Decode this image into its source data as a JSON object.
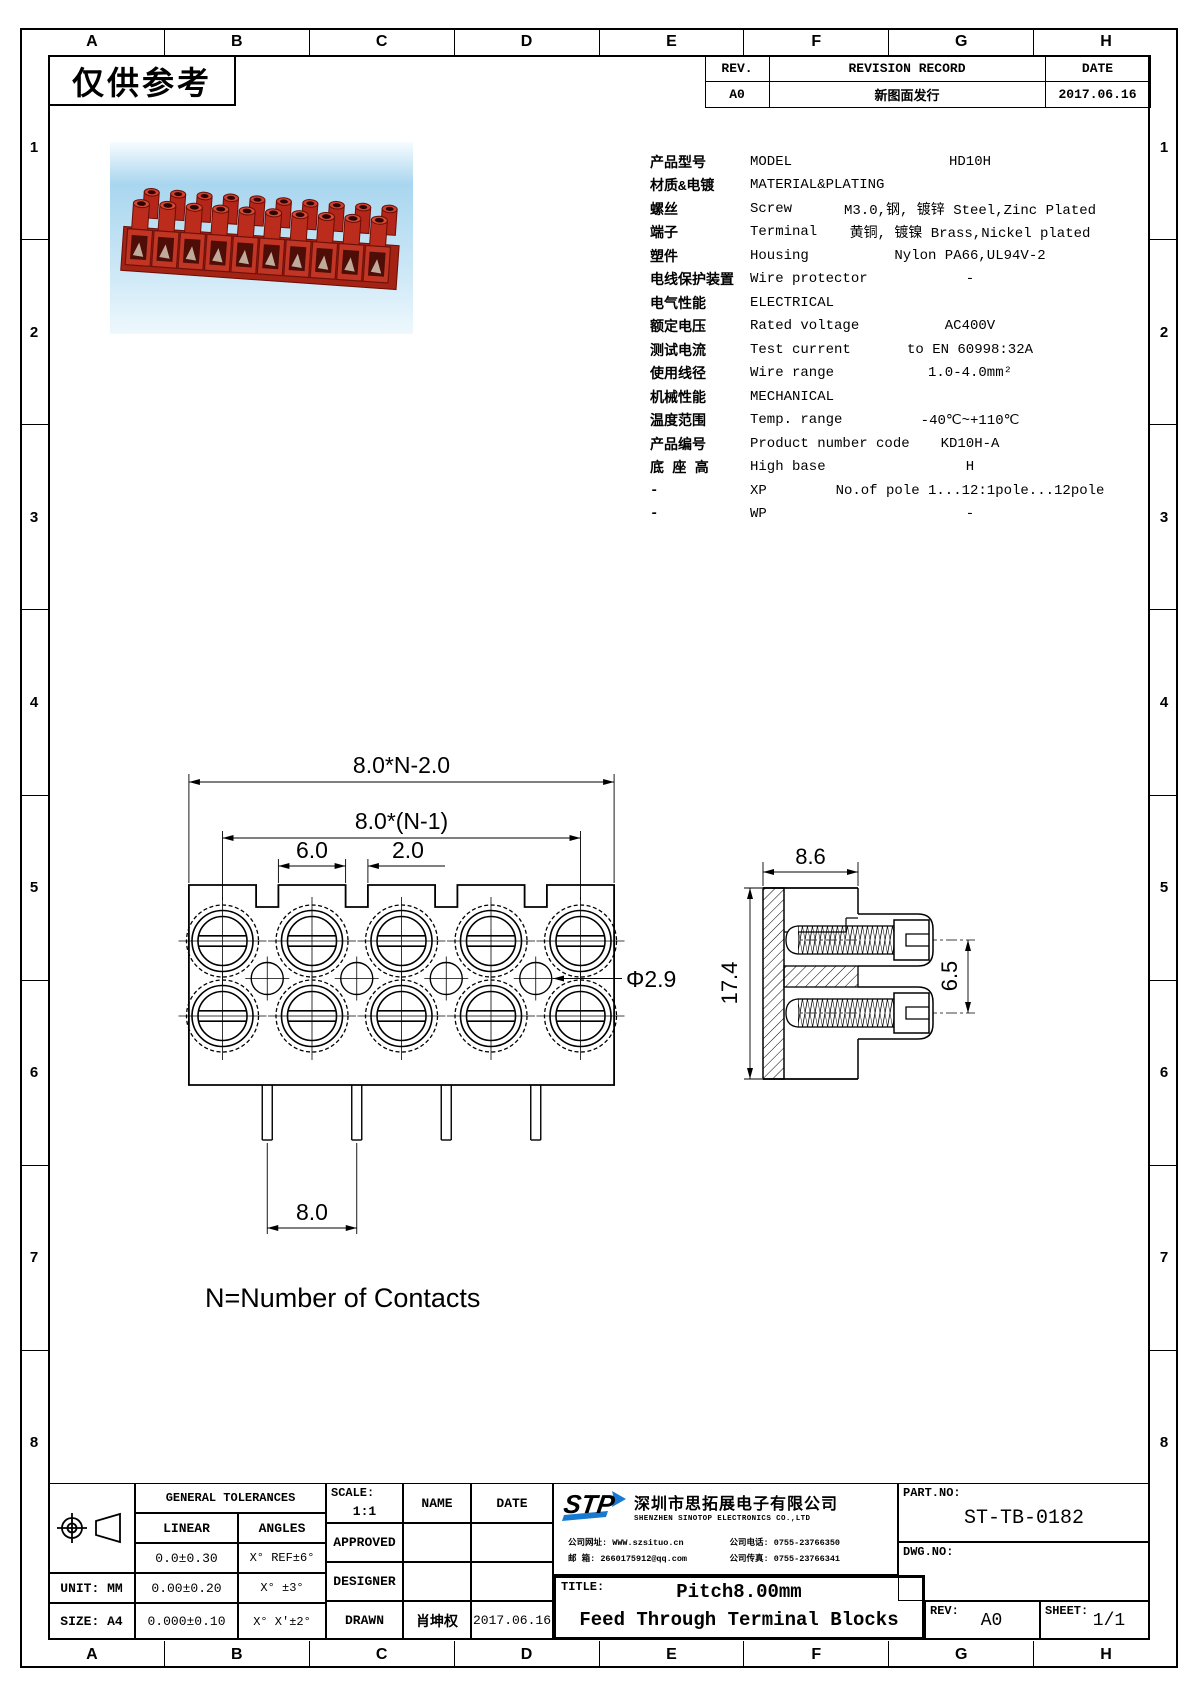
{
  "stamp": "仅供参考",
  "grid": {
    "cols": [
      "A",
      "B",
      "C",
      "D",
      "E",
      "F",
      "G",
      "H"
    ],
    "rows": [
      "1",
      "2",
      "3",
      "4",
      "5",
      "6",
      "7",
      "8"
    ]
  },
  "revision": {
    "rev_header": "REV.",
    "record_header": "REVISION RECORD",
    "date_header": "DATE",
    "rev": "A0",
    "record": "新图面发行",
    "date": "2017.06.16"
  },
  "specs": {
    "rows": [
      {
        "cn": "产品型号",
        "en": "MODEL",
        "value": "HD10H"
      },
      {
        "cn": "材质&电镀",
        "en": "MATERIAL&PLATING",
        "value": ""
      },
      {
        "cn": "螺丝",
        "en": "Screw",
        "value": "M3.0,钢, 镀锌 Steel,Zinc Plated"
      },
      {
        "cn": "端子",
        "en": "Terminal",
        "value": "黄铜, 镀镍 Brass,Nickel plated"
      },
      {
        "cn": "塑件",
        "en": "Housing",
        "value": "Nylon PA66,UL94V-2"
      },
      {
        "cn": "电线保护装置",
        "en": "Wire protector",
        "value": "-"
      },
      {
        "cn": "电气性能",
        "en": "ELECTRICAL",
        "value": ""
      },
      {
        "cn": "额定电压",
        "en": "Rated voltage",
        "value": "AC400V"
      },
      {
        "cn": "测试电流",
        "en": "Test current",
        "value": "to EN 60998:32A"
      },
      {
        "cn": "使用线径",
        "en": "Wire range",
        "value": "1.0-4.0mm²"
      },
      {
        "cn": "机械性能",
        "en": "MECHANICAL",
        "value": ""
      },
      {
        "cn": "温度范围",
        "en": "Temp. range",
        "value": "-40℃~+110℃"
      },
      {
        "cn": "产品编号",
        "en": "Product number code",
        "value": "KD10H-A"
      },
      {
        "cn": "底 座 高",
        "en": "High base",
        "value": "H"
      },
      {
        "cn": "-",
        "en": "XP",
        "value": "No.of pole 1...12:1pole...12pole"
      },
      {
        "cn": "-",
        "en": "WP",
        "value": "-"
      }
    ]
  },
  "drawing": {
    "dim_overall": "8.0*N-2.0",
    "dim_pitch_total": "8.0*(N-1)",
    "dim_tab": "6.0",
    "dim_gap": "2.0",
    "dim_pitch": "8.0",
    "dim_hole": "Φ2.9",
    "dim_side_width": "8.6",
    "dim_side_height": "17.4",
    "dim_screw_spacing": "6.5",
    "note": "N=Number of Contacts"
  },
  "titleblock": {
    "tol_header": "GENERAL TOLERANCES",
    "linear_header": "LINEAR",
    "angles_header": "ANGLES",
    "linear": [
      "0.0±0.30",
      "0.00±0.20",
      "0.000±0.10"
    ],
    "angles": [
      "X° REF±6°",
      "X° ±3°",
      "X° X'±2°"
    ],
    "unit": "UNIT: MM",
    "size": "SIZE: A4",
    "scale_label": "SCALE:",
    "scale_value": "1:1",
    "name_header": "NAME",
    "date_header": "DATE",
    "approved_label": "APPROVED",
    "designer_label": "DESIGNER",
    "drawn_label": "DRAWN",
    "drawn_name": "肖坤权",
    "drawn_date": "2017.06.16",
    "company": {
      "logo": "STP",
      "cn_name": "深圳市思拓展电子有限公司",
      "en_name": "SHENZHEN SINOTOP ELECTRONICS CO.,LTD",
      "website_label": "公司网址:",
      "website": "WWW.szsituo.cn",
      "phone_label": "公司电话:",
      "phone": "0755-23766350",
      "email_label": "邮  箱:",
      "email": "2660175912@qq.com",
      "fax_label": "公司传真:",
      "fax": "0755-23766341"
    },
    "part_no_label": "PART.NO:",
    "part_no": "ST-TB-0182",
    "dwg_no_label": "DWG.NO:",
    "title_label": "TITLE:",
    "title_line1": "Pitch8.00mm",
    "title_line2": "Feed Through Terminal Blocks",
    "rev_label": "REV:",
    "rev_value": "A0",
    "sheet_label": "SHEET:",
    "sheet_value": "1/1"
  }
}
